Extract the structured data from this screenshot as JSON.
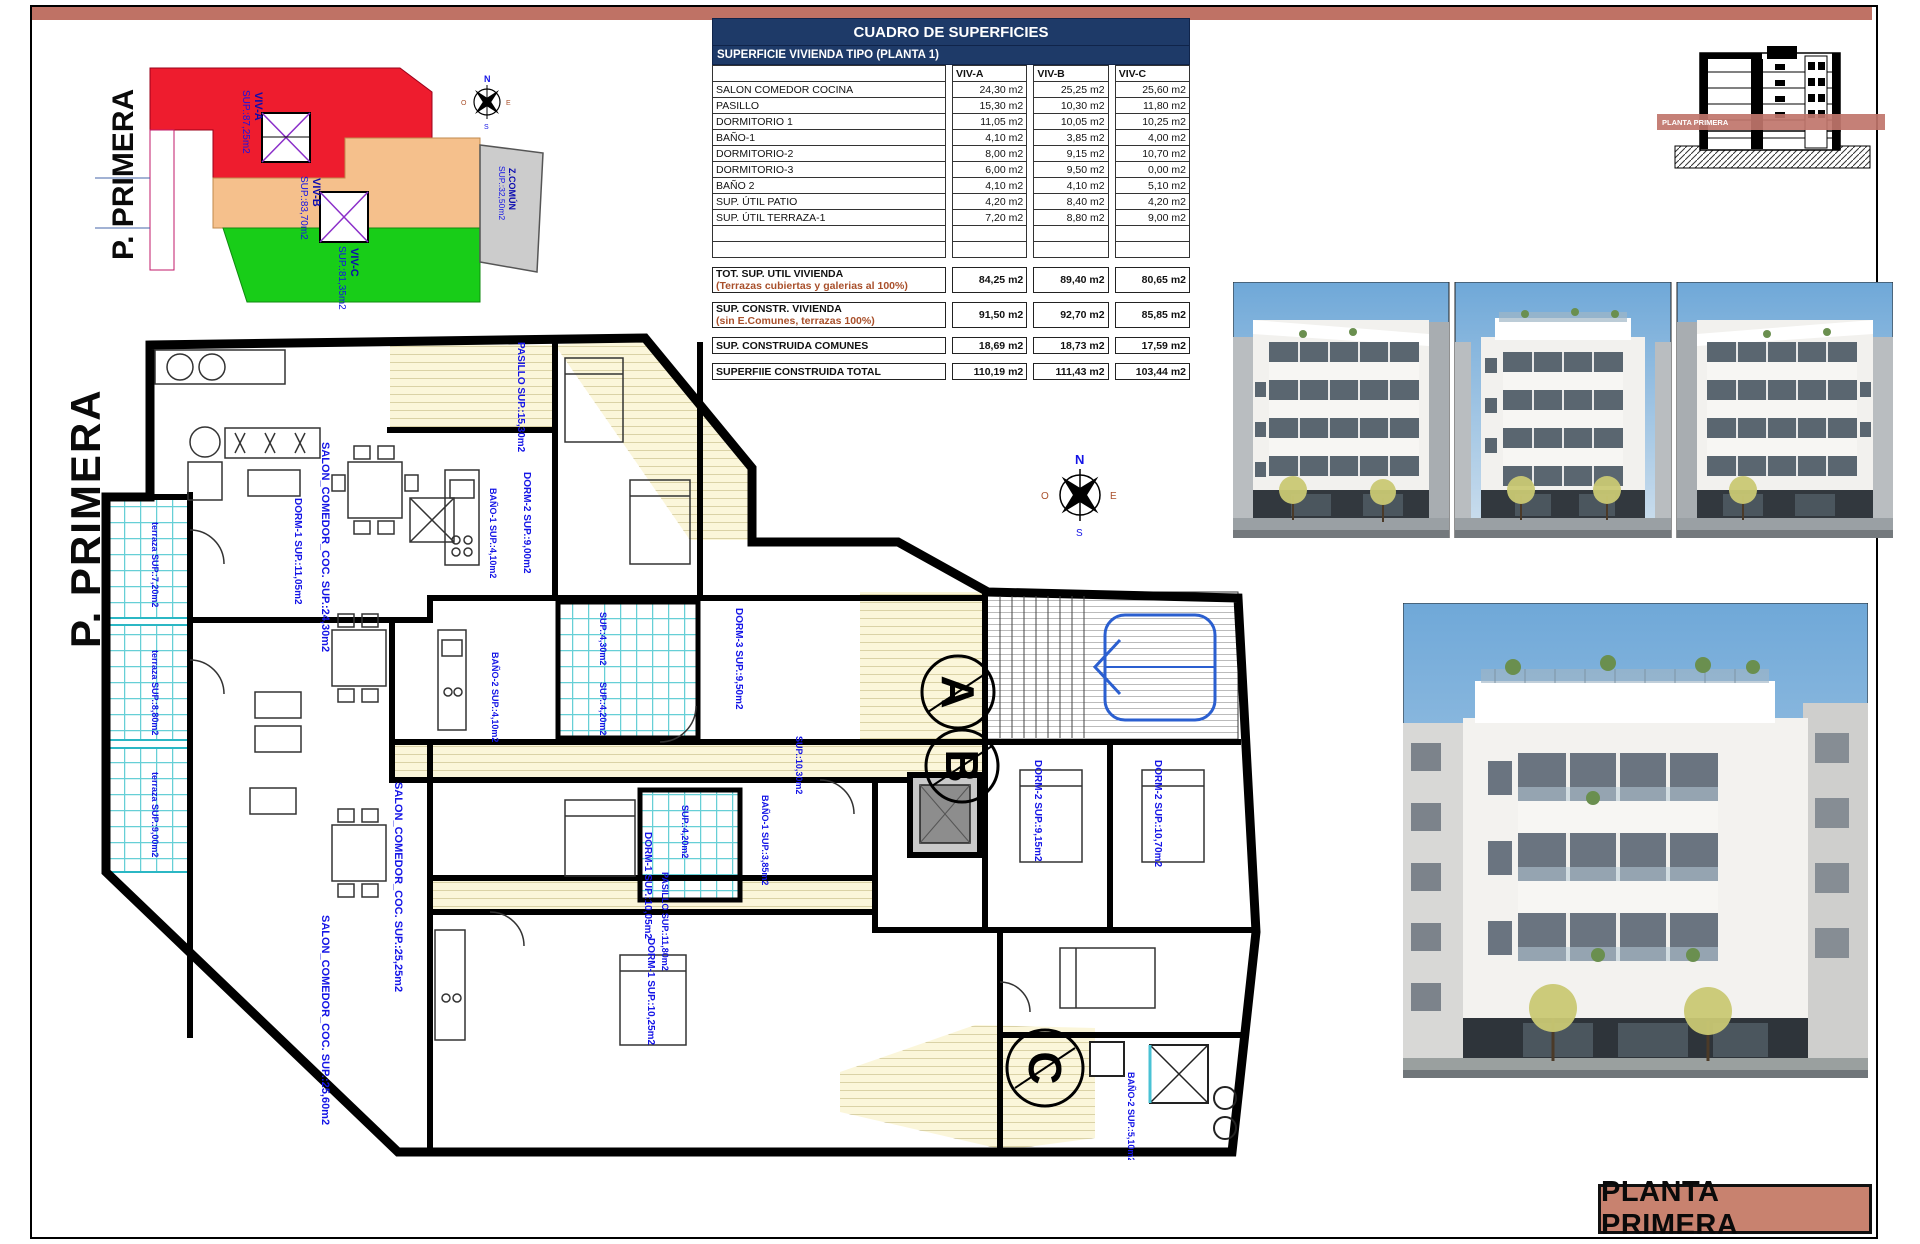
{
  "page": {
    "top_bar_color": "#bf7265",
    "title_block_label": "PLANTA PRIMERA",
    "title_block_bg": "#c8826f"
  },
  "key_plan": {
    "title": "P. PRIMERA",
    "zones": [
      {
        "label": "VIV-A",
        "sup": "SUP.:87,25m2",
        "color": "#ee1c2e"
      },
      {
        "label": "VIV-B",
        "sup": "SUP.:83,70m2",
        "color": "#f5c08c"
      },
      {
        "label": "VIV-C",
        "sup": "SUP.:81,35m2",
        "color": "#18cd18"
      },
      {
        "label": "Z.COMÚN",
        "sup": "SUP.:32,50m2",
        "color": "#cccccc"
      }
    ]
  },
  "table": {
    "title": "CUADRO DE SUPERFICIES",
    "subtitle": "SUPERFICIE VIVIENDA TIPO  (PLANTA 1)",
    "columns": [
      "VIV-A",
      "VIV-B",
      "VIV-C"
    ],
    "rows": [
      {
        "label": "SALON COMEDOR COCINA",
        "values": [
          "24,30 m2",
          "25,25 m2",
          "25,60 m2"
        ]
      },
      {
        "label": "PASILLO",
        "values": [
          "15,30 m2",
          "10,30 m2",
          "11,80 m2"
        ]
      },
      {
        "label": "DORMITORIO 1",
        "values": [
          "11,05 m2",
          "10,05 m2",
          "10,25 m2"
        ]
      },
      {
        "label": "BAÑO-1",
        "values": [
          "4,10 m2",
          "3,85 m2",
          "4,00 m2"
        ]
      },
      {
        "label": "DORMITORIO-2",
        "values": [
          "8,00 m2",
          "9,15 m2",
          "10,70 m2"
        ]
      },
      {
        "label": "DORMITORIO-3",
        "values": [
          "6,00 m2",
          "9,50 m2",
          "0,00 m2"
        ]
      },
      {
        "label": "BAÑO 2",
        "values": [
          "4,10 m2",
          "4,10 m2",
          "5,10 m2"
        ]
      },
      {
        "label": "SUP. ÚTIL PATIO",
        "values": [
          "4,20 m2",
          "8,40 m2",
          "4,20 m2"
        ]
      },
      {
        "label": "SUP. ÚTIL TERRAZA-1",
        "values": [
          "7,20 m2",
          "8,80 m2",
          "9,00 m2"
        ]
      }
    ],
    "summary_rows": [
      {
        "label": "TOT. SUP. UTIL VIVIENDA",
        "sublabel": "(Terrazas cubiertas y galerias al 100%)",
        "values": [
          "84,25 m2",
          "89,40 m2",
          "80,65 m2"
        ]
      },
      {
        "label": "SUP. CONSTR. VIVIENDA",
        "sublabel": "(sin E.Comunes, terrazas 100%)",
        "values": [
          "91,50 m2",
          "92,70 m2",
          "85,85 m2"
        ]
      },
      {
        "label": "SUP. CONSTRUIDA COMUNES",
        "sublabel": "",
        "values": [
          "18,69 m2",
          "18,73 m2",
          "17,59 m2"
        ]
      },
      {
        "label": "SUPERFIIE CONSTRUIDA TOTAL",
        "sublabel": "",
        "values": [
          "110,19 m2",
          "111,43 m2",
          "103,44 m2"
        ]
      }
    ],
    "header_bg": "#1e3a68",
    "accent_text": "#a9502b"
  },
  "section_drawing": {
    "band_label": "PLANTA PRIMERA"
  },
  "floor_plan": {
    "title": "P. PRIMERA",
    "unit_markers": [
      "A",
      "B",
      "C"
    ],
    "compass": {
      "n": "N",
      "s": "S",
      "e": "E",
      "o": "O"
    },
    "labels": [
      {
        "t": "PASILLO  SUP.:15,30m2",
        "x": 458,
        "y": 12,
        "s": 10
      },
      {
        "t": "SALON_COMEDOR_COC.  SUP.:24,30m2",
        "x": 262,
        "y": 112,
        "s": 11
      },
      {
        "t": "DORM-1  SUP.:11,05m2",
        "x": 235,
        "y": 168,
        "s": 10
      },
      {
        "t": "DORM-2  SUP.:9,00m2",
        "x": 464,
        "y": 142,
        "s": 10
      },
      {
        "t": "BAÑO-1  SUP.:4,10m2",
        "x": 430,
        "y": 158,
        "s": 9
      },
      {
        "t": "BAÑO-2  SUP.:4,10m2",
        "x": 432,
        "y": 322,
        "s": 9
      },
      {
        "t": "SUP.:4,30m2",
        "x": 540,
        "y": 282,
        "s": 9
      },
      {
        "t": "SUP.:4,20m2",
        "x": 540,
        "y": 352,
        "s": 9
      },
      {
        "t": "DORM-3  SUP.:9,50m2",
        "x": 676,
        "y": 278,
        "s": 10
      },
      {
        "t": "SUP.:10,30m2",
        "x": 736,
        "y": 406,
        "s": 9
      },
      {
        "t": "SALON_COMEDOR_COC.  SUP.:25,25m2",
        "x": 335,
        "y": 452,
        "s": 11
      },
      {
        "t": "DORM-1  SUP.:10,05m2",
        "x": 585,
        "y": 502,
        "s": 10
      },
      {
        "t": "BAÑO-1  SUP.:3,85m2",
        "x": 702,
        "y": 465,
        "s": 9
      },
      {
        "t": "DORM-2  SUP.:9,15m2",
        "x": 975,
        "y": 430,
        "s": 10
      },
      {
        "t": "DORM-2  SUP.:10,70m2",
        "x": 1095,
        "y": 430,
        "s": 10
      },
      {
        "t": "PASILLO  SUP.:11,80m2",
        "x": 602,
        "y": 542,
        "s": 9
      },
      {
        "t": "SALON_COMEDOR_COC.  SUP.:25,60m2",
        "x": 262,
        "y": 585,
        "s": 11
      },
      {
        "t": "DORM-1  SUP.:10,25m2",
        "x": 588,
        "y": 608,
        "s": 10
      },
      {
        "t": "BAÑO-2  SUP.:5,10m2",
        "x": 1068,
        "y": 742,
        "s": 9
      },
      {
        "t": "SUP.:4,20m2",
        "x": 622,
        "y": 475,
        "s": 9
      },
      {
        "t": "terraza  SUP.:7,20m2",
        "x": 92,
        "y": 192,
        "s": 9
      },
      {
        "t": "terraza  SUP.:8,80m2",
        "x": 92,
        "y": 320,
        "s": 9
      },
      {
        "t": "terraza  SUP.:9,00m2",
        "x": 92,
        "y": 442,
        "s": 9
      }
    ]
  }
}
